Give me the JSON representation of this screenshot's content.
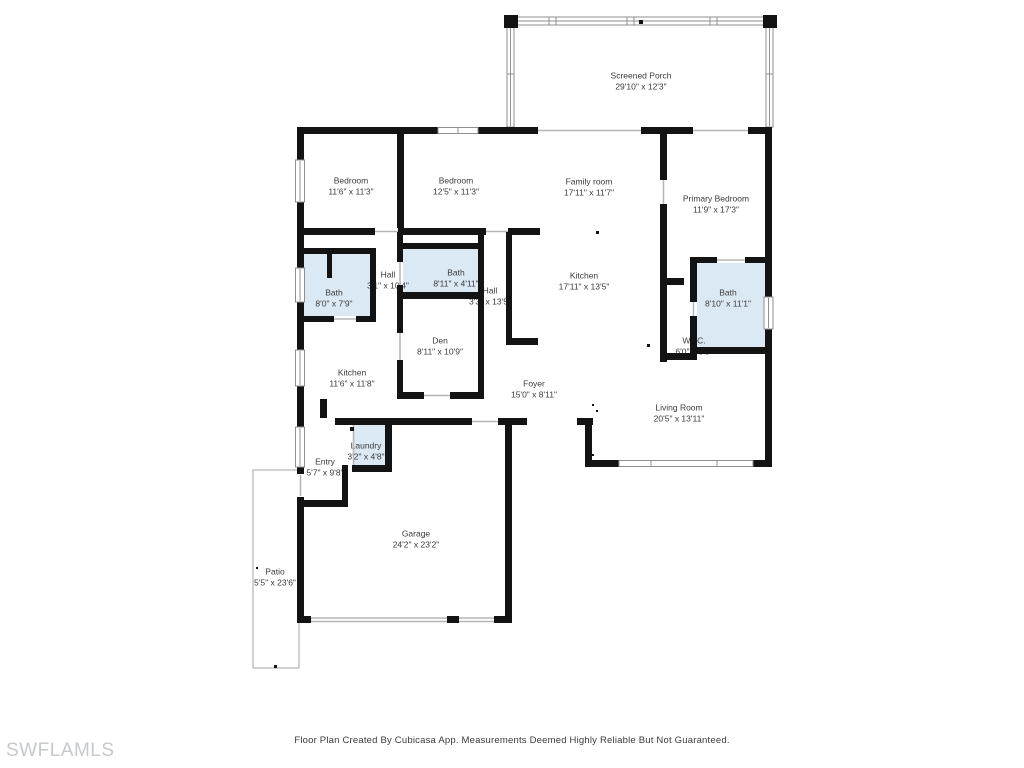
{
  "page": {
    "watermark": "SWFLAMLS",
    "footer": "Floor Plan Created By Cubicasa App. Measurements Deemed Highly Reliable But Not Guaranteed."
  },
  "colors": {
    "wall": "#131313",
    "bath_fill": "#dbe9f5",
    "label_text": "#3a3a3a",
    "window_line": "#8f8f8f",
    "opening_line": "#b5b5b5",
    "patio_outline": "#b5b5b5",
    "watermark_text": "#c6c9cb"
  },
  "rooms": [
    {
      "id": "screened-porch",
      "name": "Screened Porch",
      "dims": "29'10\" x 12'3\""
    },
    {
      "id": "bedroom-1",
      "name": "Bedroom",
      "dims": "11'6\" x 11'3\""
    },
    {
      "id": "bedroom-2",
      "name": "Bedroom",
      "dims": "12'5\" x 11'3\""
    },
    {
      "id": "family-room",
      "name": "Family room",
      "dims": "17'11\" x 11'7\""
    },
    {
      "id": "primary-bedroom",
      "name": "Primary Bedroom",
      "dims": "11'9\" x 17'3\""
    },
    {
      "id": "bath-1",
      "name": "Bath",
      "dims": "8'0\" x 7'9\""
    },
    {
      "id": "hall-1",
      "name": "Hall",
      "dims": "3'1\" x 10'4\""
    },
    {
      "id": "bath-2",
      "name": "Bath",
      "dims": "8'11\" x 4'11\""
    },
    {
      "id": "hall-2",
      "name": "Hall",
      "dims": "3'3\" x 13'5\""
    },
    {
      "id": "kitchen-main",
      "name": "Kitchen",
      "dims": "17'11\" x 13'5\""
    },
    {
      "id": "bath-3",
      "name": "Bath",
      "dims": "8'10\" x 11'1\""
    },
    {
      "id": "den",
      "name": "Den",
      "dims": "8'11\" x 10'9\""
    },
    {
      "id": "wic",
      "name": "W.I.C.",
      "dims": "6'0\" x 3'8\""
    },
    {
      "id": "kitchen-2",
      "name": "Kitchen",
      "dims": "11'6\" x 11'8\""
    },
    {
      "id": "foyer",
      "name": "Foyer",
      "dims": "15'0\" x 8'11\""
    },
    {
      "id": "living-room",
      "name": "Living Room",
      "dims": "20'5\" x 13'11\""
    },
    {
      "id": "laundry",
      "name": "Laundry",
      "dims": "3'2\" x 4'8\""
    },
    {
      "id": "entry",
      "name": "Entry",
      "dims": "5'7\" x 9'8\""
    },
    {
      "id": "garage",
      "name": "Garage",
      "dims": "24'2\" x 23'2\""
    },
    {
      "id": "patio",
      "name": "Patio",
      "dims": "5'5\" x 23'6\""
    }
  ]
}
